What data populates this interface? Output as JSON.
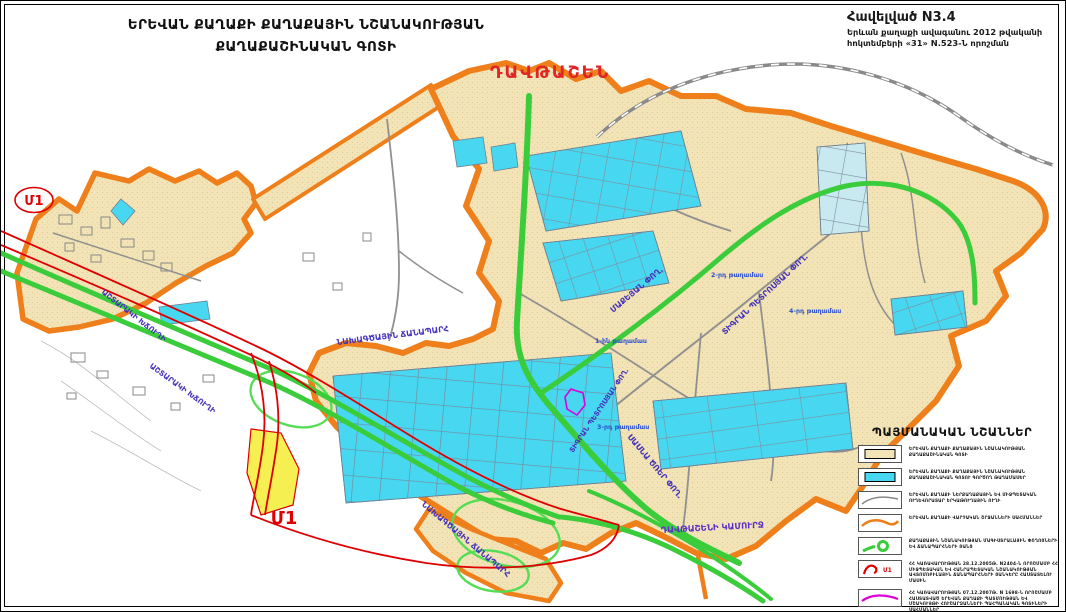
{
  "title": {
    "line1": "ԵՐԵՎԱՆ ՔԱՂԱՔԻ ՔԱՂԱՔԱՅԻՆ ՆՇԱՆԱԿՈՒԹՅԱՆ",
    "line2": "ՔԱՂԱՔԱՇԻՆԱԿԱՆ ԳՈՏԻ"
  },
  "annex": {
    "line1": "Հավելված N3.4",
    "line2": "Երևան քաղաքի ավագանու 2012 թվականի",
    "line3": "հոկտեմբերի «31»  N.523-Ն    որոշման"
  },
  "map": {
    "district_name": "ԴԱՎԹԱՇԵՆ",
    "m1_left": "Մ1",
    "m1_bottom": "Մ1",
    "road_labels": [
      "ԱՇՏԱՐԱԿԻ ԽՃՈՒՂԻ",
      "ԱՇՏԱՐԱԿԻ ԽՃՈՒՂԻ",
      "ՆԱԽԱԳԾԱՅԻՆ ՃԱՆԱՊԱՐՀ",
      "ՆԱԽԱԳԾԱՅԻՆ ՃԱՆԱՊԱՐՀ",
      "ՄԱՔԵՅԱՆ ՓՈՂ.",
      "ՏԻԳՐԱՆ ՊԵՏՐՈՍՅԱՆ ՓՈՂ.",
      "ՏԻԳՐԱՆ ՊԵՏՐՈՍՅԱՆ ՓՈՂ.",
      "ՍԱՍՆԱ ԾՌԵՐ ՓՈՂ.",
      "ԴԱՎԹԱՇԵՆԻ ԿԱՄՈՒՐՋ"
    ],
    "district_blocks": [
      "1-ին թաղամաս",
      "2-րդ թաղամաս",
      "3-րդ թաղամաս",
      "4-րդ թաղամաս"
    ]
  },
  "legend": {
    "title": "ՊԱՅՄԱՆԱԿԱՆ ՆՇԱՆՆԵՐ",
    "m1_symbol_label": "Մ1",
    "items": [
      {
        "text": "ԵՐԵՎԱՆ ՔԱՂԱՔԻ ՔԱՂԱՔԱՅԻՆ ՆՇԱՆԱԿՈՒԹՅԱՆ ՔԱՂԱՔԱՇԻՆԱԿԱՆ ԳՈՏԻ"
      },
      {
        "text": "ԵՐԵՎԱՆ ՔԱՂԱՔԻ ՔԱՂԱՔԱՅԻՆ ՆՇԱՆԱԿՈՒԹՅԱՆ ՔԱՂԱՔԱՇԻՆԱԿԱՆ ԳՈՏՈՒ ԳՈՐԾՈՂ ԹԱՂԱՄԱՍԵՐ"
      },
      {
        "text": "ԵՐԵՎԱՆ ՔԱՂԱՔԻ ՆԵՐՔԱՂԱՔԱՅԻՆ ԵՎ ՄԻՋՊԵՏԱԿԱՆ ՈՒՂԵՎՈՐԱՏԱՐ ԵՐԿԱԹՈՒՂԱՅԻՆ ՈՒՂԻ"
      },
      {
        "text": "ԵՐԵՎԱՆ ՔԱՂԱՔԻ ՎԱՐՉԱԿԱՆ ՇՐՋԱՆՆԵՐԻ ՍԱՀՄԱՆՆԵՐ"
      },
      {
        "text": "ՔԱՂԱՔԱՅԻՆ ՆՇԱՆԱԿՈՒԹՅԱՆ ՄԱԳԻՍՏՐԱԼԱՅԻՆ ՓՈՂՈՑՆԵՐԻ ԵՎ ՃԱՆԱՊԱՐՀՆԵՐԻ ՑԱՆՑ"
      },
      {
        "text": "ՀՀ ԿԱՌԱՎԱՐՈՒԹՅԱՆ 28.12.2005Թ. N2404-Ն ՈՐՈՇՄԱՄԲ ՀՀ ՄԻՋՊԵՏԱԿԱՆ ԵՎ ՀԱՆՐԱՊԵՏԱԿԱՆ ՆՇԱՆԱԿՈՒԹՅԱՆ ԱՎՏՈՄՈԲԻԼԱՅԻՆ ՃԱՆԱՊԱՐՀՆԵՐԻ ՑԱՆԿԵՐԸ ՀԱՍՏԱՏԵԼՈՒ ՄԱՍԻՆ"
      },
      {
        "text": "ՀՀ ԿԱՌԱՎԱՐՈՒԹՅԱՆ 07.12.2007Թ. N 1698-Ն ՈՐՈՇՄԱՄԲ ՀԱՍՏԱՏՎԱԾ ԵՐԵՎԱՆ ՔԱՂԱՔԻ ՊԱՏՄՈՒԹՅԱՆ ԵՎ ՄՇԱԿՈՒՅԹԻ ՀՈՒՇԱՐՁԱՆՆԵՐԻ ՊԱՀՊԱՆԱԿԱՆ ԳՈՏԻՆԵՐԻ ՍԱՀՄԱՆՆԵՐ"
      }
    ]
  },
  "colors": {
    "zone_fill": "#F2E4B6",
    "blocks_fill": "#48D7F0",
    "boundary_orange": "#EE7F1A",
    "main_road_green": "#3BCC3B",
    "m1_red": "#DE0000",
    "monument_magenta": "#DD00DD",
    "road_label_purple": "#4433BB",
    "district_label_red": "#E02525",
    "block_label_blue": "#2B4FD0",
    "interchange_yellow": "#F6EF52"
  }
}
